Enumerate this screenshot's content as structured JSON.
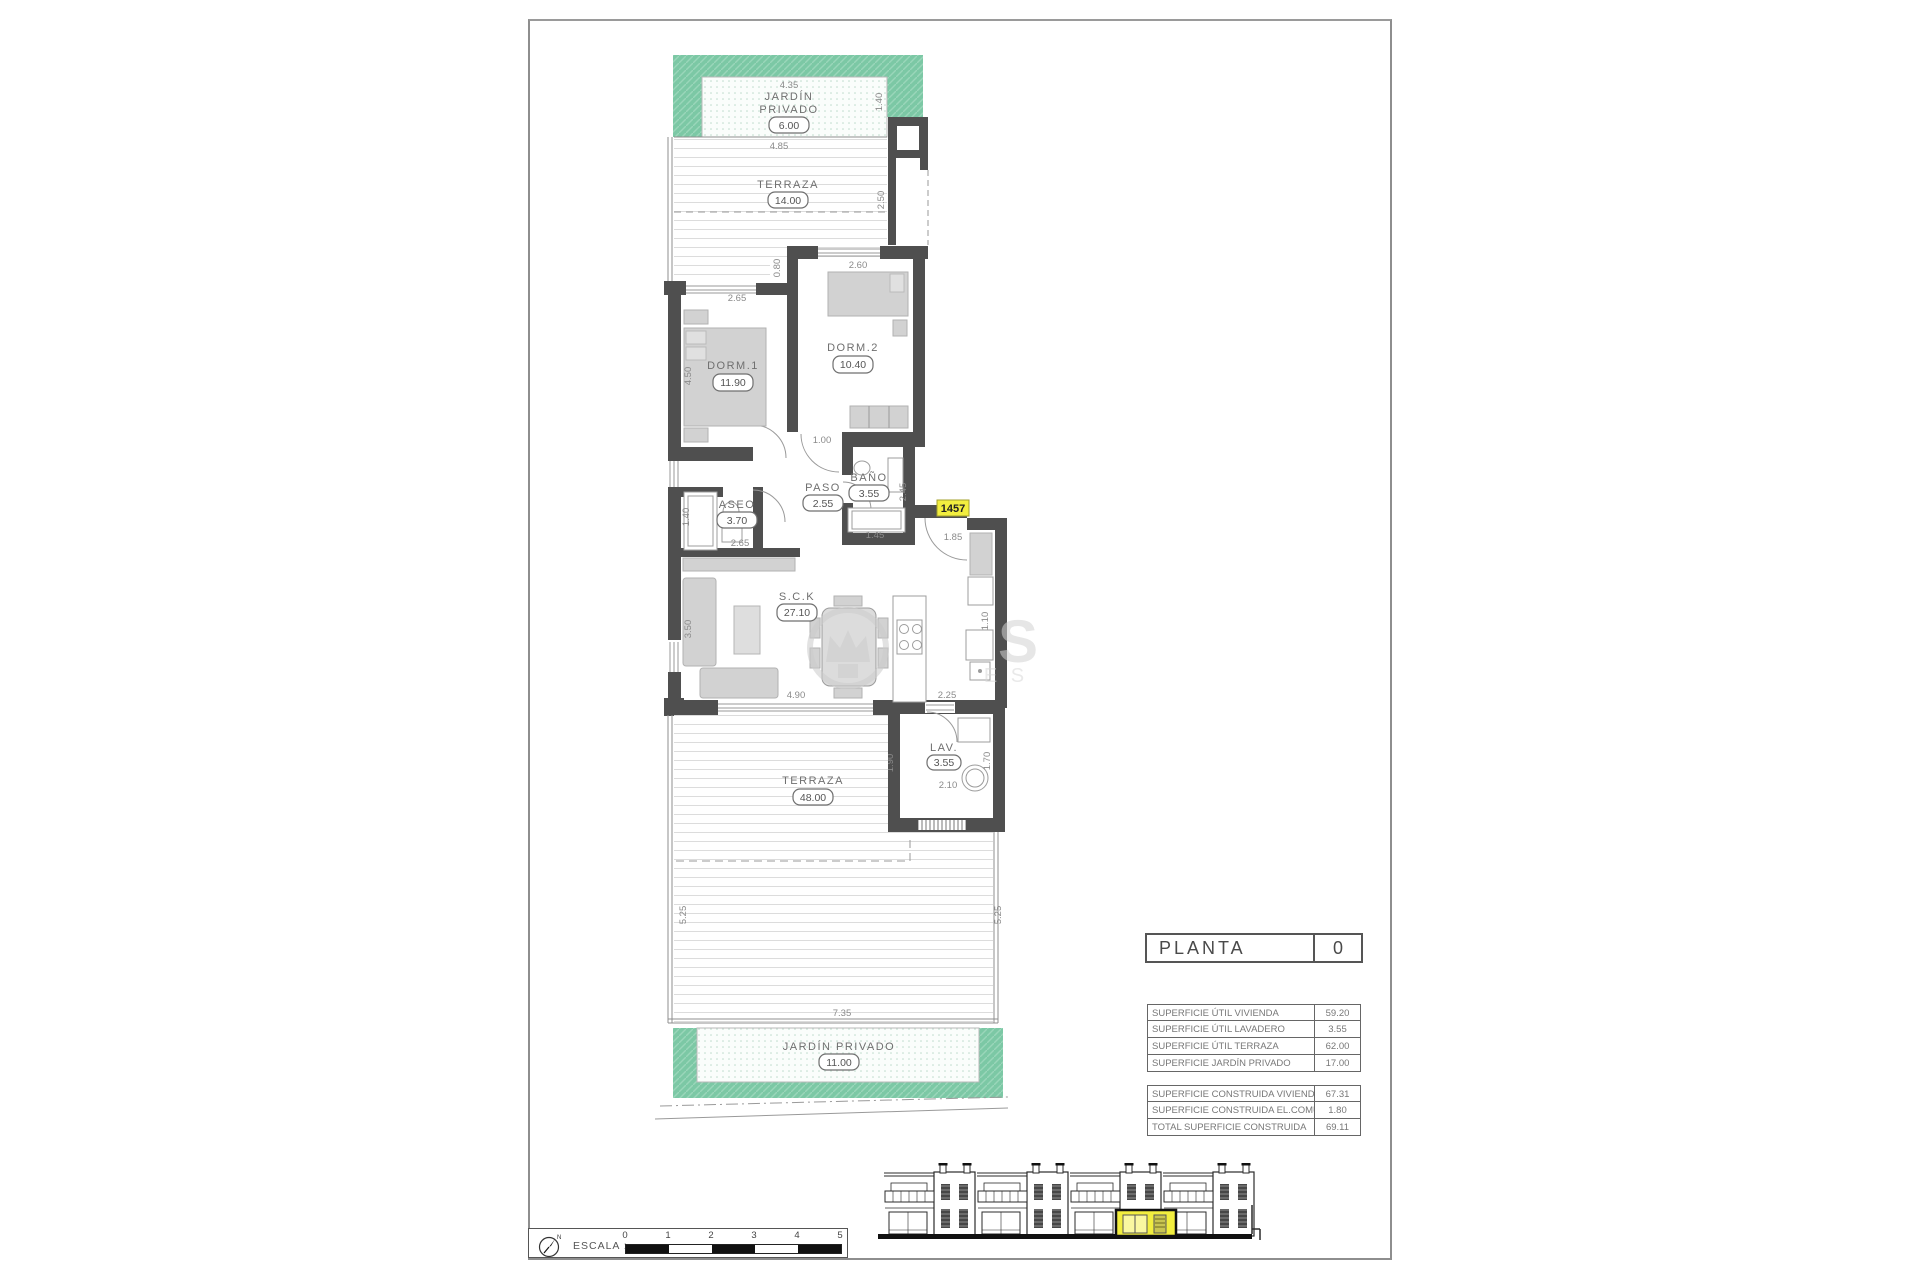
{
  "plan": {
    "unit_number": "1457",
    "rooms": {
      "jardin_top": {
        "line1": "JARDÍN",
        "line2": "PRIVADO",
        "area": "6.00"
      },
      "terraza_top": {
        "name": "TERRAZA",
        "area": "14.00"
      },
      "dorm1": {
        "name": "DORM.1",
        "area": "11.90"
      },
      "dorm2": {
        "name": "DORM.2",
        "area": "10.40"
      },
      "aseo": {
        "name": "ASEO",
        "area": "3.70"
      },
      "paso": {
        "name": "PASO",
        "area": "2.55"
      },
      "bano": {
        "name": "BAÑO",
        "area": "3.55"
      },
      "sck": {
        "name": "S.C.K",
        "area": "27.10"
      },
      "lav": {
        "name": "LAV.",
        "area": "3.55"
      },
      "terraza_bottom": {
        "name": "TERRAZA",
        "area": "48.00"
      },
      "jardin_bottom": {
        "name": "JARDÍN  PRIVADO",
        "area": "11.00"
      }
    },
    "dims": {
      "d435": "4.35",
      "d140t": "1.40",
      "d485": "4.85",
      "d250": "2.50",
      "d265a": "2.65",
      "d080": "0.80",
      "d260": "2.60",
      "d450": "4.50",
      "d100": "1.00",
      "d245": "2.45",
      "d145": "1.45",
      "d185": "1.85",
      "d140b": "1.40",
      "d265b": "2.65",
      "d350": "3.50",
      "d110": "1.10",
      "d490": "4.90",
      "d225": "2.25",
      "d190": "1.90",
      "d210": "2.10",
      "d170": "1.70",
      "d525l": "5.25",
      "d525r": "5.25",
      "d735": "7.35"
    }
  },
  "watermark": {
    "letter": "S",
    "sub": "E S"
  },
  "title_block": {
    "label": "PLANTA",
    "value": "0"
  },
  "area_table": {
    "groups": [
      {
        "rows": [
          {
            "label": "SUPERFICIE ÚTIL VIVIENDA",
            "value": "59.20"
          },
          {
            "label": "SUPERFICIE ÚTIL LAVADERO",
            "value": "3.55"
          },
          {
            "label": "SUPERFICIE ÚTIL TERRAZA",
            "value": "62.00"
          },
          {
            "label": "SUPERFICIE JARDÍN PRIVADO",
            "value": "17.00"
          }
        ]
      },
      {
        "rows": [
          {
            "label": "SUPERFICIE CONSTRUIDA VIVIENDA",
            "value": "67.31"
          },
          {
            "label": "SUPERFICIE CONSTRUIDA EL.COMUNES",
            "value": "1.80"
          },
          {
            "label": "TOTAL SUPERFICIE CONSTRUIDA",
            "value": "69.11"
          }
        ]
      }
    ]
  },
  "scale_bar": {
    "label": "ESCALA :",
    "ticks": [
      "0",
      "1",
      "2",
      "3",
      "4",
      "5"
    ]
  },
  "north_label": "N",
  "colors": {
    "garden_green": "#7cc8a5",
    "highlight_yellow": "#f2ee3f",
    "wall": "#4f4f4f"
  }
}
